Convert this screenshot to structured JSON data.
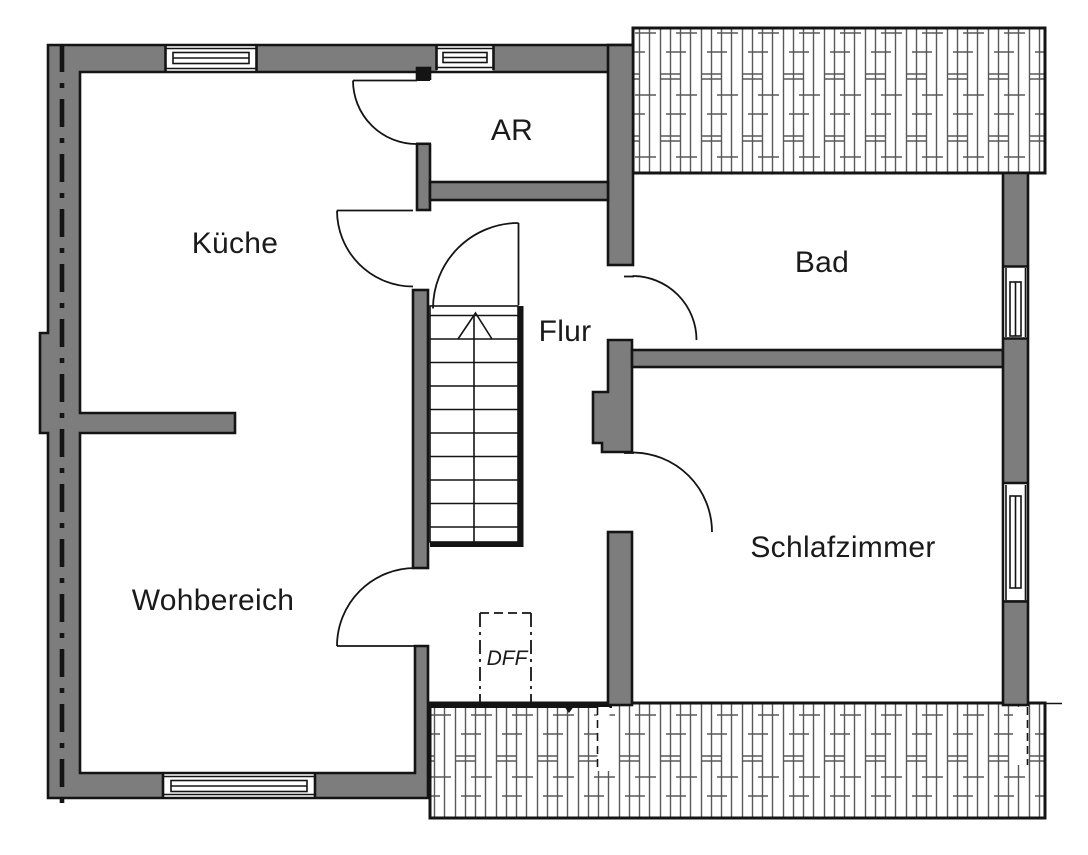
{
  "colors": {
    "background": "#ffffff",
    "wall_fill": "#7d7d7d",
    "outline": "#141414",
    "hatch": "#585858",
    "text": "#1a1a1a"
  },
  "rooms": {
    "kueche": {
      "label": "Küche"
    },
    "ar": {
      "label": "AR"
    },
    "bad": {
      "label": "Bad"
    },
    "flur": {
      "label": "Flur"
    },
    "wohnbereich": {
      "label": "Wohbereich"
    },
    "schlafzimmer": {
      "label": "Schlafzimmer"
    },
    "dachfenster": {
      "label": "DFF"
    }
  }
}
